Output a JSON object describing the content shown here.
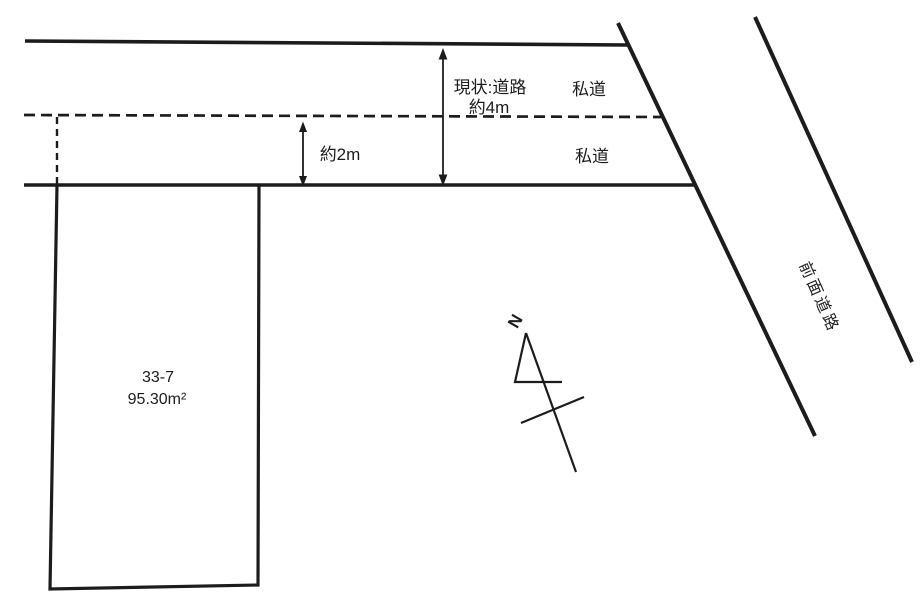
{
  "diagram": {
    "background_color": "#ffffff",
    "line_color": "#1c1c1c",
    "parcel": {
      "number": "33-7",
      "area": "95.30m²"
    },
    "roads": {
      "private_upper": "私道",
      "private_lower": "私道",
      "front": "前面道路"
    },
    "measurements": {
      "current_road_line1": "現状:道路",
      "current_road_line2": "約4m",
      "private_road_width": "約2m"
    },
    "compass": {
      "north": "N"
    }
  }
}
